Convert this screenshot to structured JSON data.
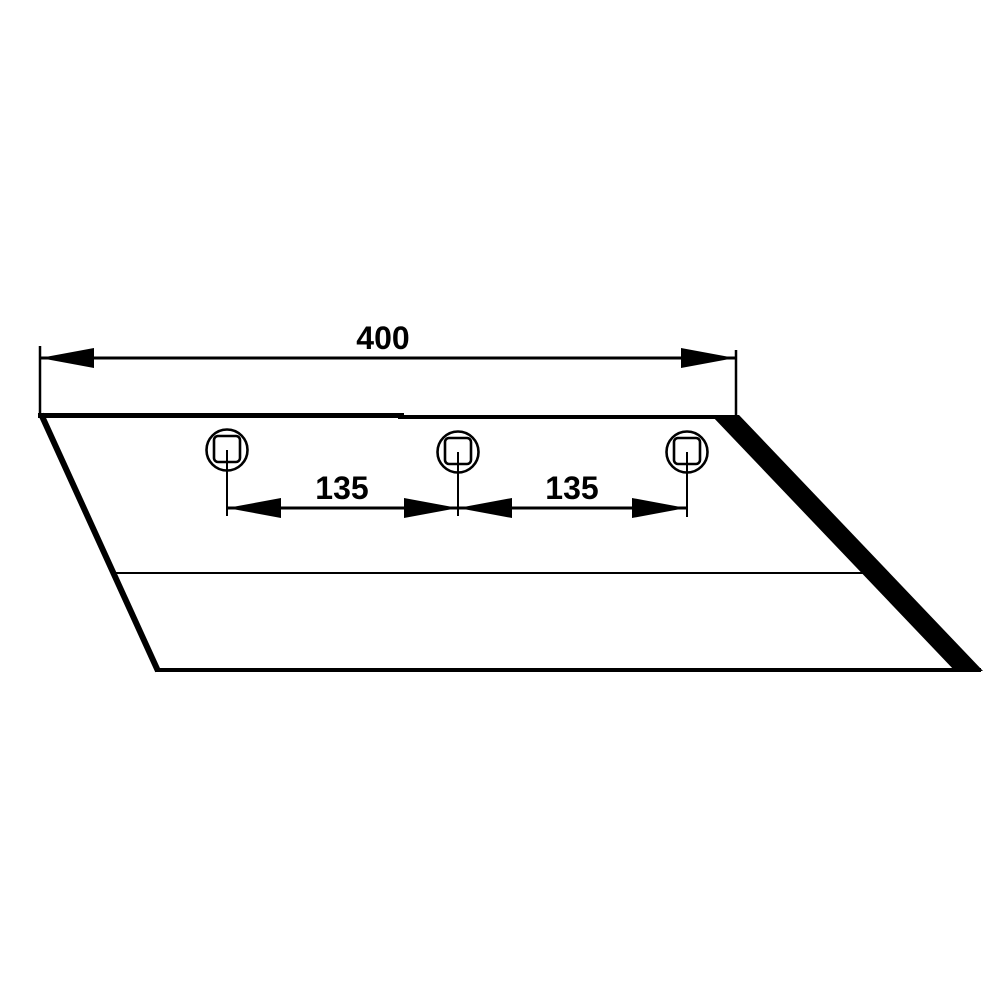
{
  "drawing": {
    "kind": "technical-drawing",
    "colors": {
      "line": "#000000",
      "background": "#ffffff"
    },
    "dimensions": {
      "overall_width": {
        "label": "400",
        "value": 400
      },
      "hole_spacing_left": {
        "label": "135",
        "value": 135
      },
      "hole_spacing_right": {
        "label": "135",
        "value": 135
      }
    },
    "holes": {
      "count": 3,
      "shape": "circle-with-square-center-hole"
    }
  }
}
